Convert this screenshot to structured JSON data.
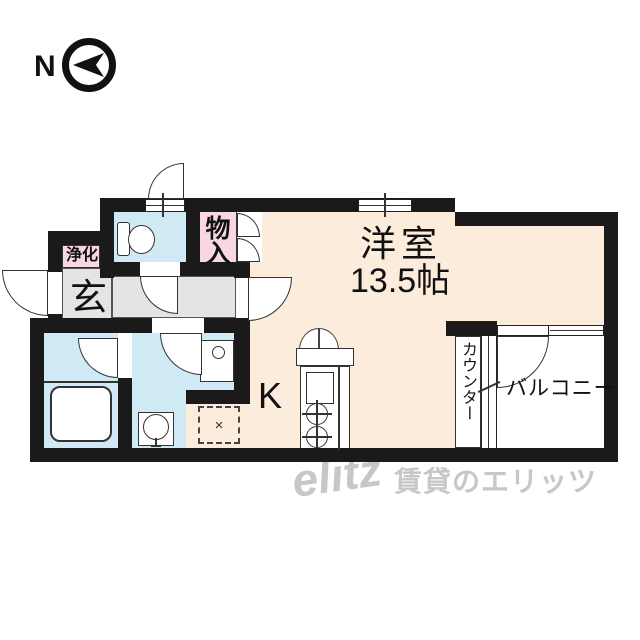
{
  "compass": {
    "north_label": "N"
  },
  "plan": {
    "main_room": {
      "name": "洋室",
      "size": "13.5帖"
    },
    "kitchen_label": "K",
    "entrance_label": "玄",
    "purifier_label": "浄化",
    "storage_label": "物入",
    "counter_label": "カウンター",
    "balcony_label": "バルコニー",
    "refrigerator_mark": "×"
  },
  "watermark": {
    "logo_text": "elitz",
    "brand_text": "賃貸のエリッツ"
  },
  "colors": {
    "wall": "#1a1a1a",
    "room_cream": "#fcecdb",
    "wet_area_blue": "#cfe9f5",
    "storage_pink": "#f8d7e3",
    "hall_gray": "#e4e4e4",
    "watermark_gray": "#c7c7c7"
  }
}
